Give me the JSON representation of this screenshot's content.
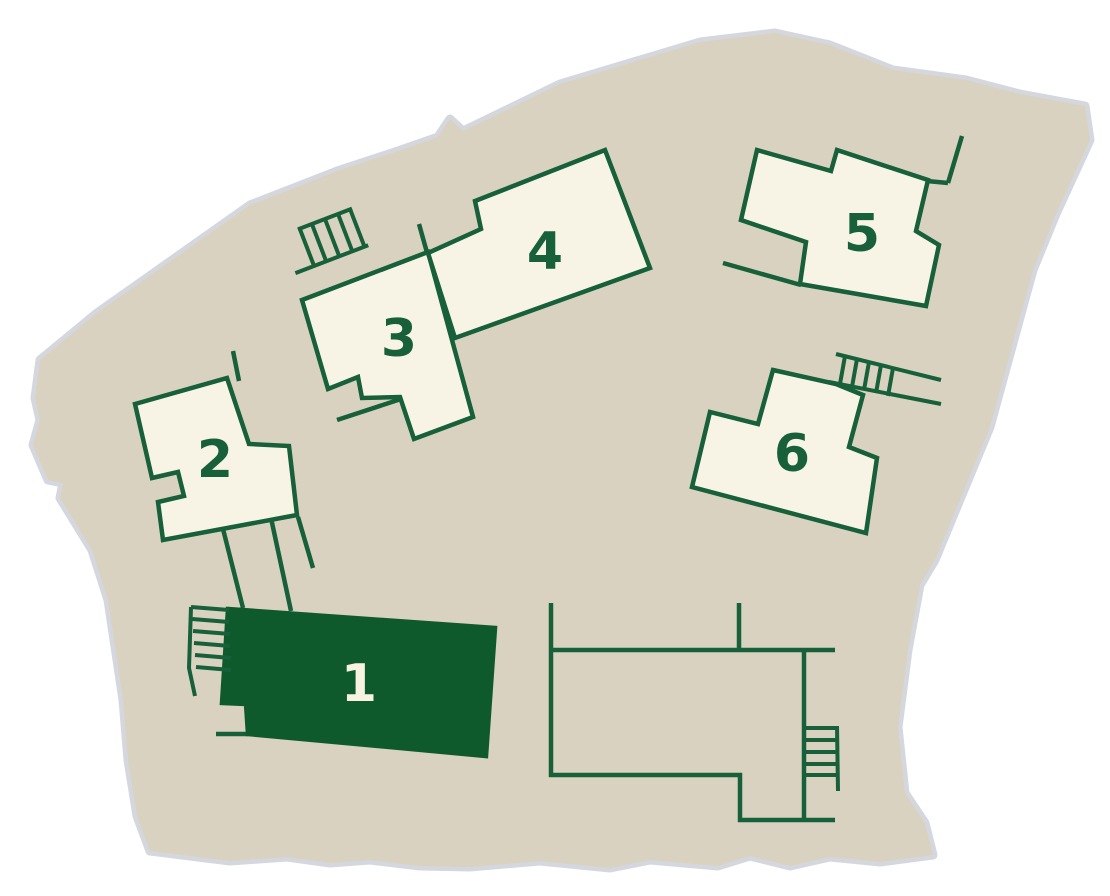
{
  "site_map": {
    "type": "site-plan",
    "description": "residential development site plan with numbered building footprints",
    "buildings": [
      {
        "number": "1",
        "selected": true
      },
      {
        "number": "2",
        "selected": false
      },
      {
        "number": "3",
        "selected": false
      },
      {
        "number": "4",
        "selected": false
      },
      {
        "number": "5",
        "selected": false
      },
      {
        "number": "6",
        "selected": false
      }
    ],
    "structures": [
      {
        "name": "terrace-outline",
        "label": ""
      }
    ],
    "icons": [
      {
        "name": "stairs-icon",
        "location": "building-1"
      },
      {
        "name": "stairs-icon",
        "location": "building-3"
      },
      {
        "name": "stairs-icon",
        "location": "building-6"
      },
      {
        "name": "stairs-icon",
        "location": "terrace"
      }
    ],
    "colors": {
      "land": "#d9d2c0",
      "land_halo": "#d5d7de",
      "building_fill": "#f8f4e5",
      "outline_green": "#17603a",
      "selected_fill": "#0f5a2c",
      "selected_label": "#f7f3e0",
      "background": "#ffffff"
    }
  }
}
